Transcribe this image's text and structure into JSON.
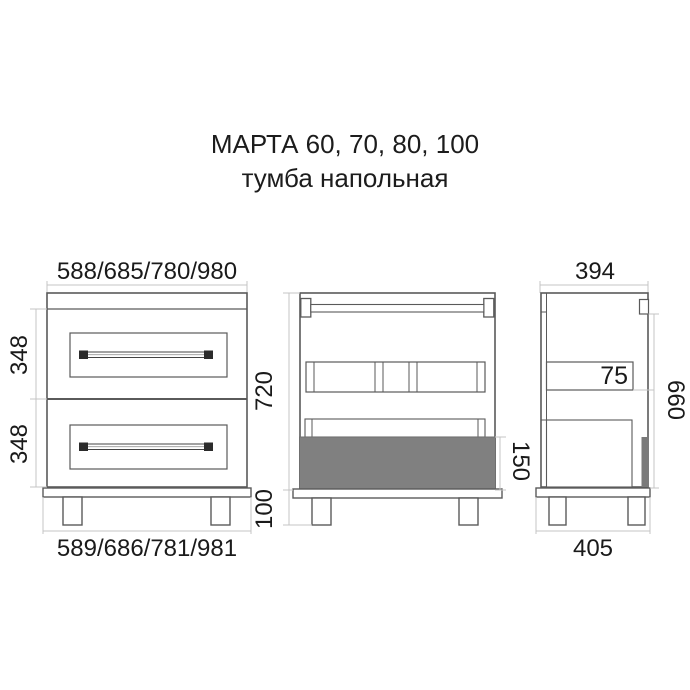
{
  "title": {
    "line1": "МАРТА 60, 70, 80, 100",
    "line2": "тумба напольная"
  },
  "front_view": {
    "top_width": "588/685/780/980",
    "bottom_width": "589/686/781/981",
    "upper_drawer_height": "348",
    "lower_drawer_height": "348"
  },
  "back_view": {
    "carcass_height": "720",
    "plinth_height": "100",
    "drawer_box_height": "150"
  },
  "side_view": {
    "top_depth": "394",
    "rail_height": "75",
    "side_height": "660",
    "bottom_depth": "405"
  },
  "colors": {
    "line": "#5a5a5a",
    "dim_line": "#c4c4c4",
    "text": "#1a1a1a",
    "gray_fill": "#808080",
    "dark_fill": "#2b2b2b",
    "background": "#ffffff"
  }
}
